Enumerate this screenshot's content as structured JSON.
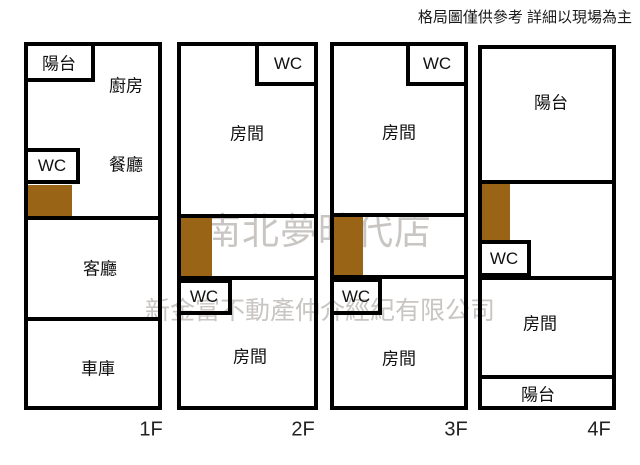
{
  "header": {
    "disclaimer": "格局圖僅供參考 詳細以現場為主"
  },
  "watermark": {
    "store": "南北夢時代店",
    "company": "新金富不動產仲介經紀有限公司"
  },
  "colors": {
    "wall": "#000000",
    "stairs": "#9a6416",
    "watermark": "#c8c5c2",
    "label": "#111111"
  },
  "floors": [
    {
      "label": "1F",
      "rooms": {
        "balcony": "陽台",
        "kitchen": "廚房",
        "wc": "WC",
        "dining": "餐廳",
        "living": "客廳",
        "garage": "車庫"
      }
    },
    {
      "label": "2F",
      "rooms": {
        "wc_top": "WC",
        "room_top": "房間",
        "wc_mid": "WC",
        "room_bottom": "房間"
      }
    },
    {
      "label": "3F",
      "rooms": {
        "wc_top": "WC",
        "room_top": "房間",
        "wc_mid": "WC",
        "room_bottom": "房間"
      }
    },
    {
      "label": "4F",
      "rooms": {
        "balcony_top": "陽台",
        "wc": "WC",
        "room": "房間",
        "balcony_bottom": "陽台"
      }
    }
  ]
}
